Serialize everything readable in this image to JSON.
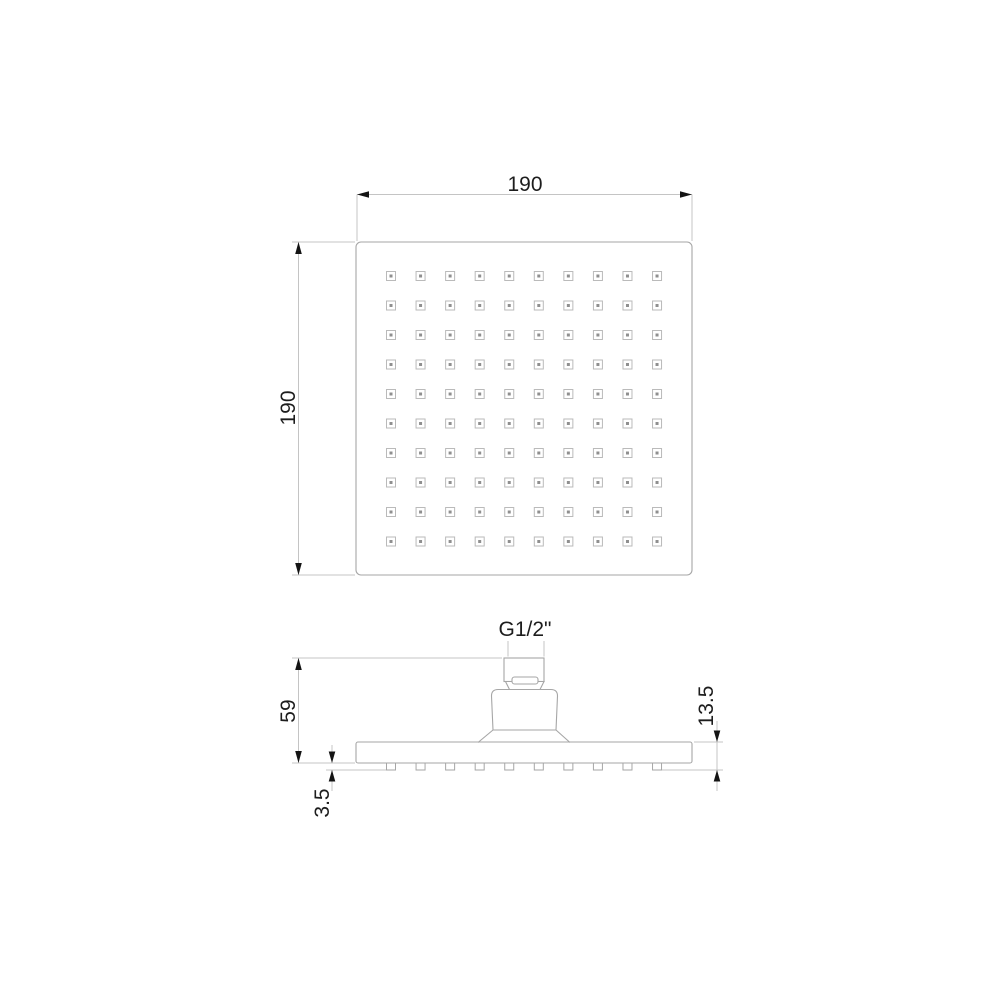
{
  "colors": {
    "background": "#ffffff",
    "part_line": "#a6a6a6",
    "dim_line": "#c4c4c4",
    "text": "#1d1d1d",
    "arrow": "#141414",
    "nozzle_line": "#bababa",
    "nozzle_dot": "#8f8f8f"
  },
  "top_view": {
    "width_label": "190",
    "height_label": "190",
    "grid": {
      "rows": 10,
      "cols": 10
    }
  },
  "side_view": {
    "thread_label": "G1/2\"",
    "height_label": "59",
    "head_depth_label": "13.5",
    "nozzle_height_label": "3.5",
    "nozzle_count": 10
  }
}
